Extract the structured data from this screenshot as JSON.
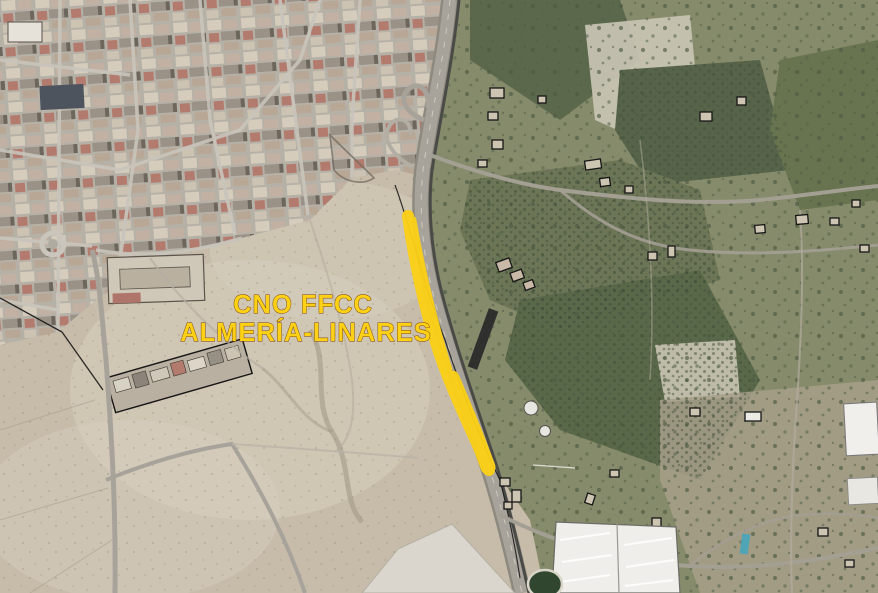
{
  "map": {
    "type": "aerial-orthophoto-with-annotation",
    "annotation": {
      "line1": "CNO FFCC",
      "line2": "ALMERÍA-LINARES"
    },
    "palette": {
      "desert": "#c7bcaa",
      "desert-light": "#d8cfbe",
      "urban-street": "#b6b1a7",
      "veg-mid": "#868b6b",
      "veg-dark": "#5b684b",
      "field-pale": "#c9c4b4",
      "greenhouse": "#efeeea",
      "road": "#a8a39a",
      "railway": "#4a4a46",
      "pond": "#31462f",
      "pool": "#4fa5b5",
      "outline": "#161616",
      "accent": "#fcd116",
      "accent-outline": "#7b3f07"
    }
  }
}
